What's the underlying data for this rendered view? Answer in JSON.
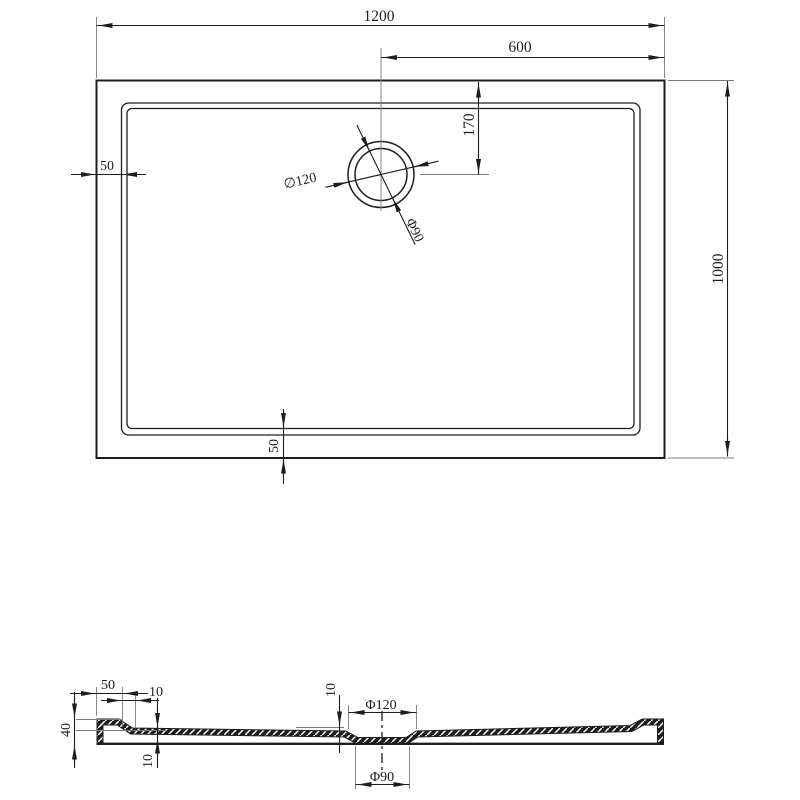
{
  "drawing": {
    "title": "shower-tray-technical-drawing",
    "colors": {
      "line": "#1d1d1d",
      "thin_line": "#7a7a7a",
      "background": "#ffffff"
    },
    "top_view": {
      "overall_width": "1200",
      "drain_center_to_right": "600",
      "drain_center_from_top": "170",
      "rim_left": "50",
      "rim_bottom": "50",
      "overall_depth": "1000",
      "drain_outer_dia": "∅120",
      "drain_inner_dia": "Φ90"
    },
    "section_view": {
      "rim_width": "50",
      "step_run": "10",
      "edge_height": "40",
      "floor_thickness": "10",
      "recess_depth": "10",
      "recess_outer_dia": "Φ120",
      "recess_inner_dia": "Φ90"
    }
  }
}
